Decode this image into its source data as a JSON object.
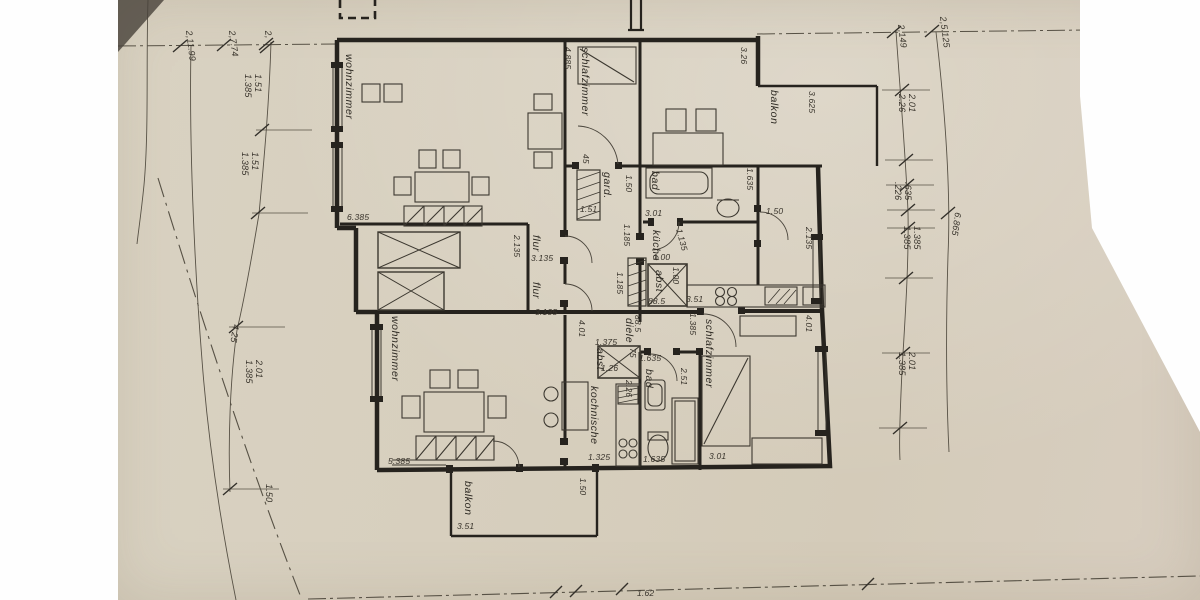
{
  "document": {
    "kind_label": "scanned floor plan drawing",
    "colors": {
      "paper": "#d7cfbe",
      "ink": "#26231e",
      "thin_line": "#5c564a",
      "scan_bg": "#fefefe"
    }
  },
  "rooms": {
    "wz_upper": "wohnzimmer",
    "sz_upper": "schlafzimmer",
    "balkon_up": "balkon",
    "wz_lower": "wohnzimmer",
    "sz_lower": "schlafzimmer",
    "kochnische": "kochnische",
    "diele": "diele",
    "bad_lower": "bad",
    "bad_upper": "bad",
    "kueche": "küche",
    "gard": "gard.",
    "abst_upper": "abst",
    "abst_lower": "abst",
    "flur_a": "flur",
    "flur_b": "flur",
    "balkon_low": "balkon"
  },
  "dims": {
    "d_6385": "6.385",
    "d_4885": "4.885",
    "d_326": "3.26",
    "d_3625": "3.625",
    "d_2135_flur": "2.135",
    "d_2135_right": "2.135",
    "d_3135_a": "3.135",
    "d_3135_b": "3.135",
    "d_1185_a": "1.185",
    "d_1185_b": "1.185",
    "d_1135": "1.135",
    "d_100_a": "1.00",
    "d_100_b": "1.00",
    "d_885_a": "88.5",
    "d_885_b": "88.5",
    "d_351_kueche": "3.51",
    "d_1385_mid": "1.385",
    "d_301_upper": "3.01",
    "d_150_right": "1.50",
    "d_1635_bad_up": "1.635",
    "d_150_gard": "1.50",
    "d_151_wall": "1.51",
    "d_45_wall": "45",
    "d_401_diele": "4.01",
    "d_401_right": "4.01",
    "d_1375": "1.375",
    "d_75": "75",
    "d_126": "1.26",
    "d_226_abst": "2.26",
    "d_1635_bad_top": "1.635",
    "d_251": "2.51",
    "d_5385": "5.385",
    "d_1325": "1.325",
    "d_1635_bad_bot": "1.635",
    "d_301_lower": "3.01",
    "d_351_balkon": "3.51",
    "d_150_balkon": "1.50",
    "d_162_bottom": "1.62"
  },
  "chains": {
    "left": {
      "c1": "2,11.99",
      "c2": "2,7.74",
      "c3": "2,",
      "c4a": "1.51",
      "c4b": "1.385",
      "c5a": "1.51",
      "c5b": "1.385",
      "c6": "4.25",
      "c7a": "2.01",
      "c7b": "1.385",
      "c8": "1.50"
    },
    "right": {
      "r1": "2,149",
      "r2": "2,5.125",
      "r3a": "2.01",
      "r3b": "2.26",
      "r4a": ".635",
      "r4b": ".226",
      "r5a": "1.385",
      "r5b": "1.385",
      "r6": "6.865",
      "r7a": "2.01",
      "r7b": "1.385"
    }
  }
}
